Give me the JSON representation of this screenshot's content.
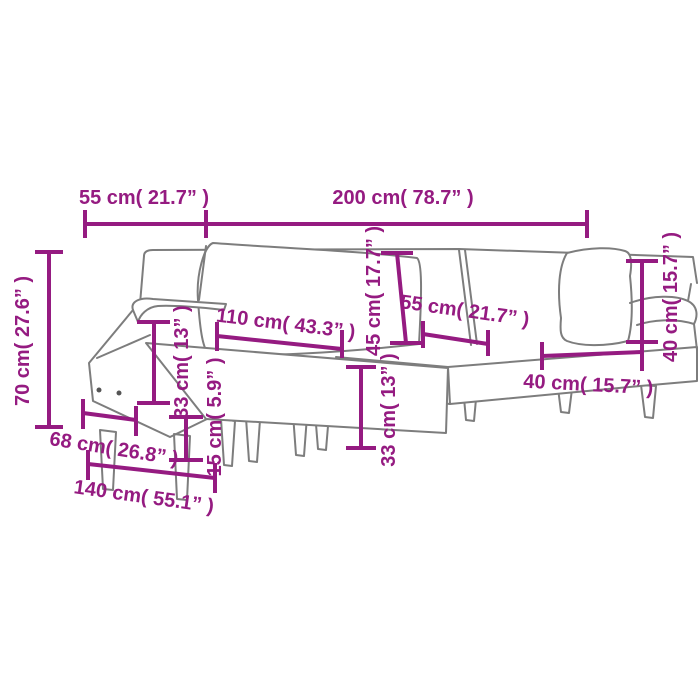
{
  "figure": {
    "title": "L-shaped sofa bed dimension diagram",
    "accent_color": "#951b81",
    "outline_color": "#7d7d7d",
    "background_color": "#ffffff"
  },
  "dimensions": {
    "dim_55_top": "55 cm( 21.7” )",
    "dim_200_top": "200 cm( 78.7” )",
    "dim_70_left": "70 cm( 27.6” )",
    "dim_110": "110 cm( 43.3” )",
    "dim_45": "45 cm( 17.7” )",
    "dim_55_mid": "55 cm( 21.7” )",
    "dim_40_v": "40 cm( 15.7” )",
    "dim_40_h": "40 cm( 15.7” )",
    "dim_33_left": "33 cm( 13” )",
    "dim_15": "15 cm( 5.9” )",
    "dim_33_mid": "33 cm( 13” )",
    "dim_68": "68 cm( 26.8” )",
    "dim_140": "140 cm( 55.1” )"
  }
}
